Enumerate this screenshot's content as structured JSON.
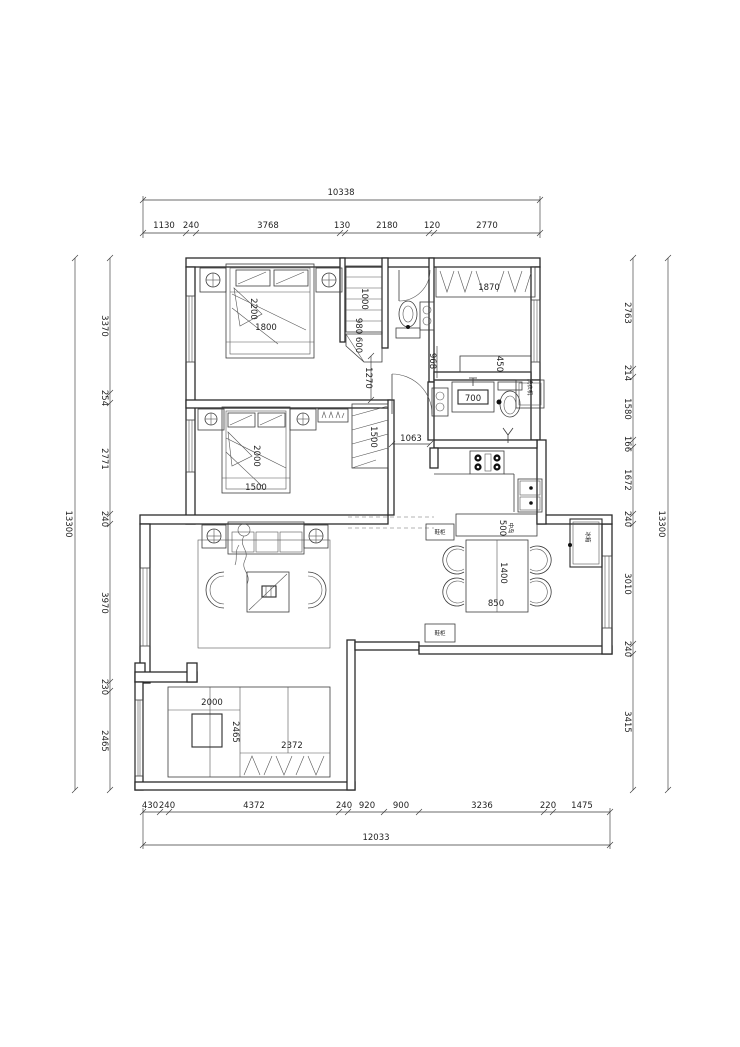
{
  "title": "apartment-floor-plan",
  "dims": {
    "top": {
      "overall": "10338",
      "segs": [
        "1130",
        "240",
        "3768",
        "130",
        "2180",
        "120",
        "2770"
      ]
    },
    "bottom": {
      "overall": "12033",
      "segs": [
        "430",
        "240",
        "4372",
        "240",
        "920",
        "900",
        "3236",
        "220",
        "1475"
      ]
    },
    "left": {
      "overall": "13300",
      "segs": [
        "3370",
        "254",
        "2771",
        "240",
        "3970",
        "230",
        "2465"
      ]
    },
    "right": {
      "overall": "13300",
      "segs": [
        "2763",
        "214",
        "1580",
        "166",
        "1672",
        "240",
        "3010",
        "240",
        "3415"
      ]
    }
  },
  "labels": {
    "bed1_length": "2200",
    "bed1_width": "1800",
    "closet_height": "1000",
    "shelf_a": "980",
    "shelf_b": "600",
    "walk_width": "1270",
    "lobby_width": "968",
    "wardrobe_main": "1870",
    "shelf_depth": "450",
    "vanity_width": "700",
    "washer": "洗衣机",
    "hall_width": "1063",
    "bed2_length": "2000",
    "bed2_width": "1500",
    "wardrobe2_width": "1500",
    "counter_depth": "500",
    "island": "中岛",
    "table_length": "1400",
    "table_width": "850",
    "fridge": "冰箱",
    "shoe_cabinet_a": "鞋柜",
    "shoe_cabinet_b": "鞋柜",
    "desk_width": "2000",
    "desk_depth": "2465",
    "wardrobe3_width": "2372"
  }
}
